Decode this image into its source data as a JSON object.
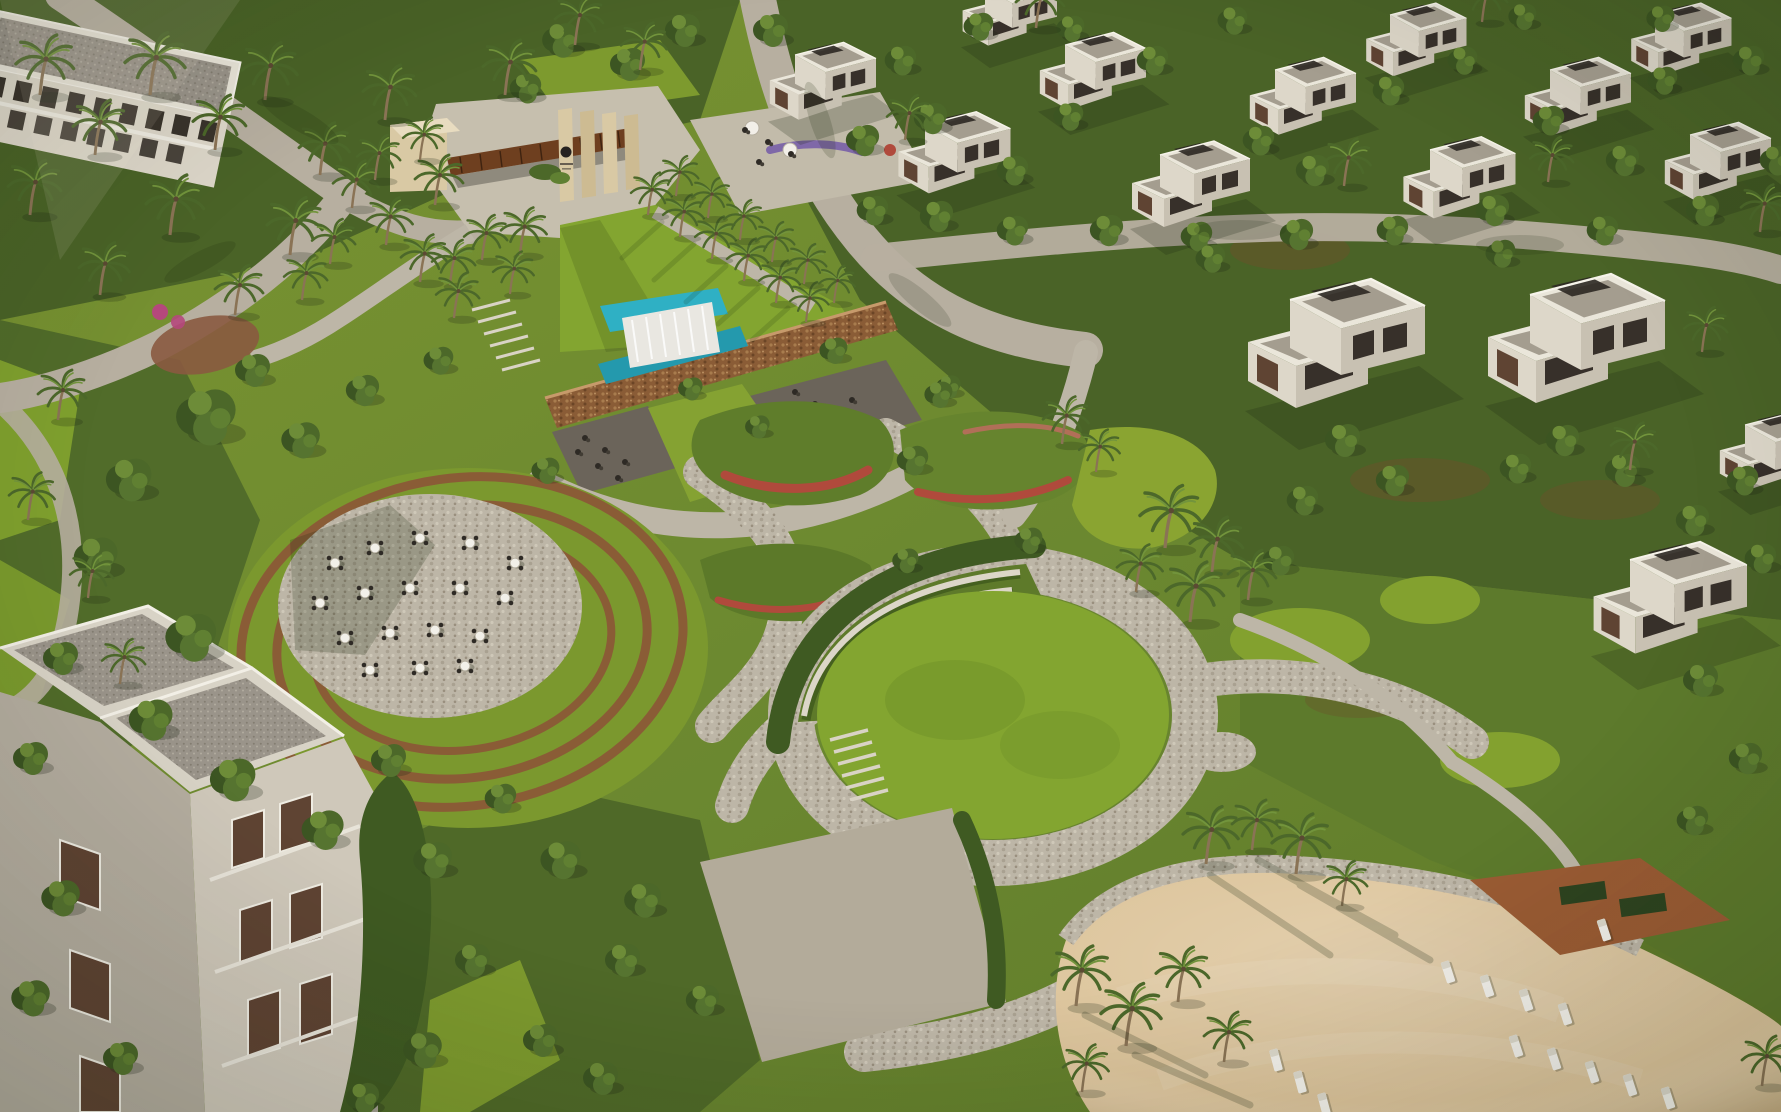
{
  "meta": {
    "description": "Aerial 3D render of a resort community masterplan: white cube villas among dense trees, palm-lined entrance gateway with pergola and logo pylons, stone wall waterfall with turquoise pools, circular terraced dining plaza with cafe tables, winding cobblestone garden paths with red flower drifts, large circular event lawn with curved steps, and a sand beach with white sun loungers.",
    "width": 1781,
    "height": 1112
  },
  "colors": {
    "ground": "#6b8830",
    "groundDark": "#4a6327",
    "canopy": "#4c6829",
    "hedge": "#3f5a22",
    "lawn": "#83a530",
    "lawnOlive": "#7b982e",
    "moundGreen": "#5e7a2a",
    "road": "#b7afa0",
    "cobble": "#bdb6a7",
    "concrete": "#c6bfae",
    "plaza": "#b3ab9a",
    "sand": "#ddc59c",
    "sandShade": "#c4a97e",
    "stoneWall": "#8a5c36",
    "pool": "#2fb0c4",
    "poolDeep": "#2499ad",
    "waterfall": "#e9e7e1",
    "villa": "#eae6da",
    "villaShade": "#c8c1b2",
    "roofGravel": "#9a948a",
    "roofSlab": "#d8d3c6",
    "windowDark": "#37302a",
    "windowBrown": "#5f4433",
    "deck": "#9b5c34",
    "flowerRed": "#b04a3c",
    "flowerPink": "#b5487c",
    "flowerPurple": "#7f68a8",
    "furnitureWhite": "#f2f0e9",
    "furnitureDark": "#2e2a25",
    "pergola": "#6e3f1f",
    "pylon": "#d9c9a4"
  },
  "scene": {
    "regions": [
      {
        "name": "entrance-gateway",
        "label": "Entrance gateway with pergola and logo pylons"
      },
      {
        "name": "entrance-lawn",
        "label": "Palm-lined entrance lawn"
      },
      {
        "name": "waterfall-feature",
        "label": "Stone wall cascade with turquoise pools and cafe terraces"
      },
      {
        "name": "terraced-dining-plaza",
        "label": "Circular terraced plaza with white cafe tables"
      },
      {
        "name": "central-gardens",
        "label": "Winding cobble paths, shrub beds, red flower drifts"
      },
      {
        "name": "great-lawn",
        "label": "Circular event lawn with three curved steps"
      },
      {
        "name": "beach",
        "label": "Sand beach with white sun loungers and palms"
      },
      {
        "name": "villas-north",
        "label": "Rows of white cube villas in trees"
      },
      {
        "name": "villas-east",
        "label": "Two large twin villas"
      },
      {
        "name": "apartments-northwest",
        "label": "Apartment block among palms"
      },
      {
        "name": "apartments-southwest",
        "label": "Apartment block with gravel roof terraces"
      }
    ],
    "instances": [
      {
        "symbol": "sym-villa",
        "layer": "layer-villas",
        "name": "villa-building",
        "items": [
          [
            795,
            55,
            0.9
          ],
          [
            925,
            125,
            0.95
          ],
          [
            1065,
            45,
            0.9
          ],
          [
            1160,
            155,
            1.0
          ],
          [
            1275,
            70,
            0.9
          ],
          [
            1390,
            15,
            0.85
          ],
          [
            1430,
            150,
            0.95
          ],
          [
            1550,
            70,
            0.9
          ],
          [
            1655,
            15,
            0.85
          ],
          [
            1690,
            135,
            0.9
          ],
          [
            985,
            -12,
            0.8
          ],
          [
            1290,
            300,
            1.5
          ],
          [
            1530,
            295,
            1.5
          ],
          [
            1630,
            560,
            1.3
          ],
          [
            1745,
            425,
            0.9
          ]
        ]
      },
      {
        "symbol": "sym-tree",
        "layer": "layer-trees",
        "name": "tree",
        "items": [
          [
            770,
            32,
            1.0
          ],
          [
            862,
            142,
            0.95
          ],
          [
            900,
            62,
            0.9
          ],
          [
            978,
            28,
            0.85
          ],
          [
            1012,
            172,
            0.9
          ],
          [
            1068,
            118,
            0.85
          ],
          [
            1152,
            62,
            0.9
          ],
          [
            1232,
            22,
            0.85
          ],
          [
            1258,
            142,
            0.9
          ],
          [
            1312,
            172,
            0.95
          ],
          [
            1388,
            92,
            0.9
          ],
          [
            1462,
            62,
            0.85
          ],
          [
            1522,
            18,
            0.8
          ],
          [
            1548,
            122,
            0.9
          ],
          [
            1622,
            162,
            0.95
          ],
          [
            1662,
            82,
            0.85
          ],
          [
            1748,
            62,
            0.9
          ],
          [
            1775,
            162,
            0.9
          ],
          [
            1702,
            212,
            0.95
          ],
          [
            1602,
            232,
            0.9
          ],
          [
            1492,
            212,
            0.95
          ],
          [
            1392,
            232,
            0.9
          ],
          [
            1296,
            236,
            0.95
          ],
          [
            1196,
            238,
            0.9
          ],
          [
            1106,
            232,
            0.95
          ],
          [
            1012,
            232,
            0.9
          ],
          [
            936,
            218,
            0.95
          ],
          [
            872,
            212,
            0.9
          ],
          [
            1070,
            30,
            0.8
          ],
          [
            1660,
            20,
            0.8
          ],
          [
            1342,
            442,
            1.0
          ],
          [
            1392,
            482,
            0.95
          ],
          [
            1302,
            502,
            0.9
          ],
          [
            1562,
            442,
            0.95
          ],
          [
            1622,
            472,
            1.0
          ],
          [
            1692,
            522,
            0.95
          ],
          [
            1742,
            482,
            0.9
          ],
          [
            1278,
            562,
            0.9
          ],
          [
            1700,
            682,
            1.0
          ],
          [
            1745,
            760,
            0.95
          ],
          [
            1692,
            822,
            0.9
          ],
          [
            1515,
            470,
            0.9
          ],
          [
            1760,
            560,
            0.9
          ],
          [
            1210,
            260,
            0.85
          ],
          [
            1500,
            255,
            0.85
          ],
          [
            833,
            352,
            0.8
          ],
          [
            948,
            388,
            0.7
          ],
          [
            1028,
            542,
            0.8
          ],
          [
            757,
            428,
            0.7
          ],
          [
            905,
            562,
            0.75
          ],
          [
            690,
            390,
            0.7
          ],
          [
            205,
            420,
            1.7
          ],
          [
            128,
            482,
            1.3
          ],
          [
            95,
            560,
            1.25
          ],
          [
            190,
            640,
            1.45
          ],
          [
            150,
            722,
            1.25
          ],
          [
            232,
            782,
            1.3
          ],
          [
            322,
            832,
            1.2
          ],
          [
            300,
            442,
            1.1
          ],
          [
            252,
            372,
            1.0
          ],
          [
            362,
            392,
            0.95
          ],
          [
            438,
            362,
            0.85
          ],
          [
            60,
            660,
            1.0
          ],
          [
            30,
            760,
            1.0
          ],
          [
            560,
            862,
            1.15
          ],
          [
            642,
            902,
            1.05
          ],
          [
            622,
            962,
            1.0
          ],
          [
            702,
            1002,
            0.95
          ],
          [
            540,
            1042,
            1.0
          ],
          [
            600,
            1080,
            1.0
          ],
          [
            388,
            762,
            1.0
          ],
          [
            432,
            862,
            1.1
          ],
          [
            472,
            962,
            1.0
          ],
          [
            422,
            1052,
            1.1
          ],
          [
            362,
            1100,
            0.95
          ],
          [
            500,
            800,
            0.9
          ],
          [
            545,
            472,
            0.8
          ],
          [
            912,
            462,
            0.9
          ],
          [
            938,
            396,
            0.8
          ],
          [
            525,
            90,
            0.9
          ],
          [
            560,
            42,
            1.05
          ],
          [
            627,
            66,
            1.0
          ],
          [
            682,
            32,
            1.0
          ],
          [
            930,
            120,
            0.95
          ],
          [
            60,
            900,
            1.1
          ],
          [
            30,
            1000,
            1.1
          ],
          [
            120,
            1060,
            1.0
          ]
        ]
      },
      {
        "symbol": "sym-palm",
        "layer": "layer-palms",
        "name": "palm-tree",
        "items": [
          [
            40,
            95,
            1.2
          ],
          [
            95,
            155,
            1.1
          ],
          [
            30,
            215,
            1.1
          ],
          [
            150,
            95,
            1.25
          ],
          [
            215,
            150,
            1.1
          ],
          [
            170,
            235,
            1.2
          ],
          [
            265,
            100,
            1.15
          ],
          [
            320,
            175,
            1.05
          ],
          [
            290,
            255,
            1.15
          ],
          [
            385,
            120,
            1.1
          ],
          [
            435,
            205,
            1.0
          ],
          [
            505,
            95,
            1.1
          ],
          [
            520,
            255,
            0.95
          ],
          [
            100,
            295,
            1.05
          ],
          [
            235,
            315,
            1.0
          ],
          [
            450,
            285,
            0.9
          ],
          [
            575,
            45,
            1.0
          ],
          [
            640,
            70,
            0.95
          ],
          [
            352,
            208,
            0.95
          ],
          [
            386,
            245,
            0.95
          ],
          [
            420,
            282,
            0.95
          ],
          [
            454,
            318,
            0.9
          ],
          [
            330,
            264,
            0.9
          ],
          [
            302,
            300,
            0.9
          ],
          [
            482,
            260,
            0.9
          ],
          [
            510,
            294,
            0.85
          ],
          [
            375,
            180,
            0.9
          ],
          [
            420,
            160,
            0.85
          ],
          [
            648,
            215,
            0.85
          ],
          [
            680,
            237,
            0.85
          ],
          [
            712,
            259,
            0.85
          ],
          [
            744,
            281,
            0.85
          ],
          [
            776,
            303,
            0.85
          ],
          [
            806,
            322,
            0.8
          ],
          [
            676,
            196,
            0.8
          ],
          [
            708,
            218,
            0.8
          ],
          [
            740,
            240,
            0.8
          ],
          [
            772,
            262,
            0.8
          ],
          [
            804,
            284,
            0.8
          ],
          [
            834,
            303,
            0.75
          ],
          [
            1165,
            548,
            1.25
          ],
          [
            1212,
            572,
            1.1
          ],
          [
            1190,
            622,
            1.2
          ],
          [
            1248,
            600,
            1.0
          ],
          [
            1136,
            592,
            0.95
          ],
          [
            1062,
            444,
            0.95
          ],
          [
            1096,
            472,
            0.85
          ],
          [
            1206,
            864,
            1.15
          ],
          [
            1252,
            850,
            1.0
          ],
          [
            1296,
            874,
            1.2
          ],
          [
            1342,
            906,
            0.9
          ],
          [
            1076,
            1006,
            1.2
          ],
          [
            1126,
            1046,
            1.25
          ],
          [
            1178,
            1002,
            1.1
          ],
          [
            1224,
            1062,
            1.0
          ],
          [
            1082,
            1092,
            0.95
          ],
          [
            1762,
            1086,
            1.0
          ],
          [
            1036,
            28,
            1.0
          ],
          [
            1344,
            186,
            0.95
          ],
          [
            1548,
            182,
            0.9
          ],
          [
            1760,
            232,
            0.95
          ],
          [
            1702,
            352,
            0.9
          ],
          [
            1482,
            22,
            0.9
          ],
          [
            905,
            140,
            0.9
          ],
          [
            1630,
            470,
            0.95
          ],
          [
            58,
            420,
            1.0
          ],
          [
            28,
            520,
            0.95
          ],
          [
            88,
            598,
            0.9
          ],
          [
            120,
            684,
            0.9
          ]
        ]
      },
      {
        "symbol": "sym-table",
        "layer": "layer-amphi-tables",
        "name": "cafe-table",
        "items": [
          [
            335,
            563
          ],
          [
            375,
            548
          ],
          [
            420,
            538
          ],
          [
            470,
            543
          ],
          [
            515,
            563
          ],
          [
            320,
            603
          ],
          [
            365,
            593
          ],
          [
            410,
            588
          ],
          [
            460,
            588
          ],
          [
            505,
            598
          ],
          [
            345,
            638
          ],
          [
            390,
            633
          ],
          [
            435,
            630
          ],
          [
            480,
            636
          ],
          [
            370,
            670
          ],
          [
            420,
            668
          ],
          [
            465,
            666
          ]
        ]
      },
      {
        "symbol": "sym-dot",
        "layer": "layer-waterfall-seats",
        "name": "terrace-seating",
        "items": [
          [
            585,
            438
          ],
          [
            605,
            450
          ],
          [
            625,
            462
          ],
          [
            598,
            466
          ],
          [
            618,
            478
          ],
          [
            578,
            452
          ],
          [
            795,
            392
          ],
          [
            815,
            404
          ],
          [
            835,
            416
          ],
          [
            808,
            420
          ],
          [
            828,
            432
          ],
          [
            788,
            406
          ],
          [
            852,
            400
          ],
          [
            860,
            424
          ]
        ]
      },
      {
        "symbol": "sym-dot",
        "layer": "layer-gate-seats",
        "name": "gate-terrace-seating",
        "items": [
          [
            745,
            130
          ],
          [
            768,
            142
          ],
          [
            791,
            154
          ],
          [
            759,
            162
          ]
        ]
      },
      {
        "symbol": "sym-lounger",
        "layer": "layer-beach-loungers",
        "name": "sun-lounger",
        "items": [
          [
            1448,
            972,
            1,
            -18
          ],
          [
            1487,
            986,
            1,
            -18
          ],
          [
            1526,
            1000,
            1,
            -18
          ],
          [
            1565,
            1014,
            1,
            -18
          ],
          [
            1516,
            1046,
            1,
            -18
          ],
          [
            1554,
            1059,
            1,
            -18
          ],
          [
            1592,
            1072,
            1,
            -18
          ],
          [
            1630,
            1085,
            1,
            -18
          ],
          [
            1668,
            1098,
            1,
            -18
          ],
          [
            1276,
            1060,
            1,
            -15
          ],
          [
            1300,
            1082,
            1,
            -15
          ],
          [
            1324,
            1104,
            1,
            -15
          ],
          [
            1604,
            930,
            1,
            -18
          ]
        ]
      }
    ]
  }
}
